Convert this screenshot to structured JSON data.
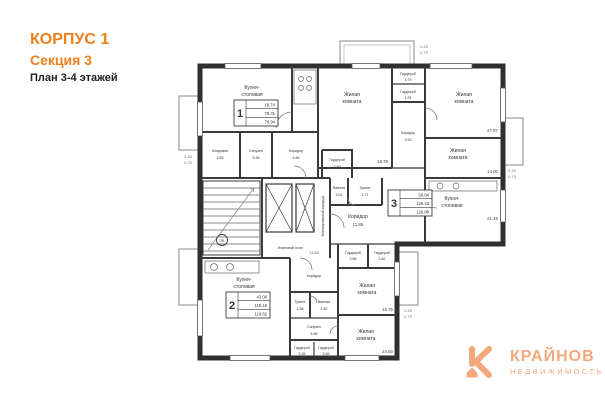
{
  "header": {
    "line1": "КОРПУС 1",
    "line2": "Секция 3",
    "line3": "План 3-4 этажей"
  },
  "colors": {
    "accent": "#ef7f1a",
    "logo": "#f2a87c",
    "wall": "#333333"
  },
  "plan": {
    "rooms": {
      "k1": {
        "n1": "Кухня-",
        "n2": "столовая"
      },
      "r1a": {
        "n1": "Жилая",
        "n2": "комната",
        "a": "18.78"
      },
      "r1b": {
        "n1": "Жилая",
        "n2": "комната",
        "a": "27.87"
      },
      "w1a": {
        "n": "Гардероб",
        "a": "1.79"
      },
      "w1b": {
        "n": "Гардероб",
        "a": "1.81"
      },
      "storage": {
        "n": "Кладовая",
        "a": "4.85"
      },
      "su1": {
        "n": "Санузел",
        "a": "5.38"
      },
      "cor1": {
        "n": "Коридор",
        "a": "5.86"
      },
      "cor3u": {
        "n": "Коридор",
        "a": "9.53"
      },
      "r3a": {
        "n1": "Жилая",
        "n2": "комната",
        "a": "14.00"
      },
      "k3": {
        "n1": "Кухня-",
        "n2": "столовая",
        "a": "21.46"
      },
      "w3": {
        "n": "Гардероб",
        "a": "2.89"
      },
      "van3": {
        "n": "Ванная",
        "a": "3.01"
      },
      "tu3": {
        "n": "Туалет",
        "a": "1.71"
      },
      "cor3": {
        "n": "Коридор",
        "a": "11.86"
      },
      "hall": {
        "n": "Лифтовой холл"
      },
      "vcor": {
        "n": "Внеквартирный коридор"
      },
      "k2": {
        "n1": "Кухня-",
        "n2": "столовая"
      },
      "cor2": {
        "n": "Коридор"
      },
      "tu2": {
        "n": "Туалет",
        "a": "1.98"
      },
      "van2": {
        "n": "Ванная",
        "a": "2.82"
      },
      "su2": {
        "n": "Санузел",
        "a": "4.86"
      },
      "w2a": {
        "n": "Гардероб",
        "a": "3.26"
      },
      "w2b": {
        "n": "Гардероб",
        "a": "3.59"
      },
      "r2a": {
        "n1": "Жилая",
        "n2": "комната",
        "a": "16.75"
      },
      "w2c": {
        "n": "Гардероб",
        "a": "2.86"
      },
      "w2d": {
        "n": "Гардероб",
        "a": "2.82"
      },
      "r2b": {
        "n1": "Жилая",
        "n2": "комната",
        "a": "24.60"
      },
      "fire": {
        "n": "ПБ"
      }
    },
    "stamps": {
      "s1": {
        "num": "1",
        "rows": [
          "18.74",
          "78.31",
          "78.94"
        ]
      },
      "s2": {
        "num": "2",
        "rows": [
          "43.08",
          "115.16",
          "116.82"
        ]
      },
      "s3": {
        "num": "3",
        "rows": [
          "56.84",
          "126.43",
          "126.88"
        ]
      }
    },
    "dims": {
      "w": "2.43",
      "h": "0.73",
      "neck": "13.86"
    }
  },
  "logo": {
    "name": "КРАЙНОВ",
    "sub": "НЕДВИЖИМОСТЬ"
  }
}
